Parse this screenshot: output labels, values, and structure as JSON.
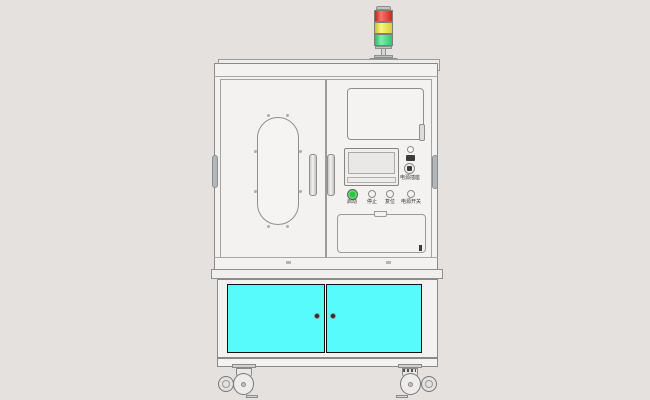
{
  "scene": {
    "description": "CAD front-view rendering of an industrial automation machine cabinet on casters",
    "background": "#e4e1df",
    "body_color": "#f3f2f0",
    "outline_color": "#8a8a8a"
  },
  "signal_tower": {
    "segments": [
      {
        "name": "red",
        "color": "#f22c1e"
      },
      {
        "name": "yellow",
        "color": "#f3ee39"
      },
      {
        "name": "green",
        "color": "#38e37a"
      }
    ]
  },
  "control_panel": {
    "power_socket_label": "电源插座",
    "buttons": [
      {
        "label": "启动",
        "color": "#21c93b"
      },
      {
        "label": "停止",
        "color": "#f4f3f1"
      },
      {
        "label": "复位",
        "color": "#f4f3f1"
      },
      {
        "label": "电源开关",
        "color": "#f4f3f1"
      }
    ]
  },
  "lower_cabinet": {
    "door_color": "#57fbfb",
    "knob_color": "#2f2f2f"
  }
}
